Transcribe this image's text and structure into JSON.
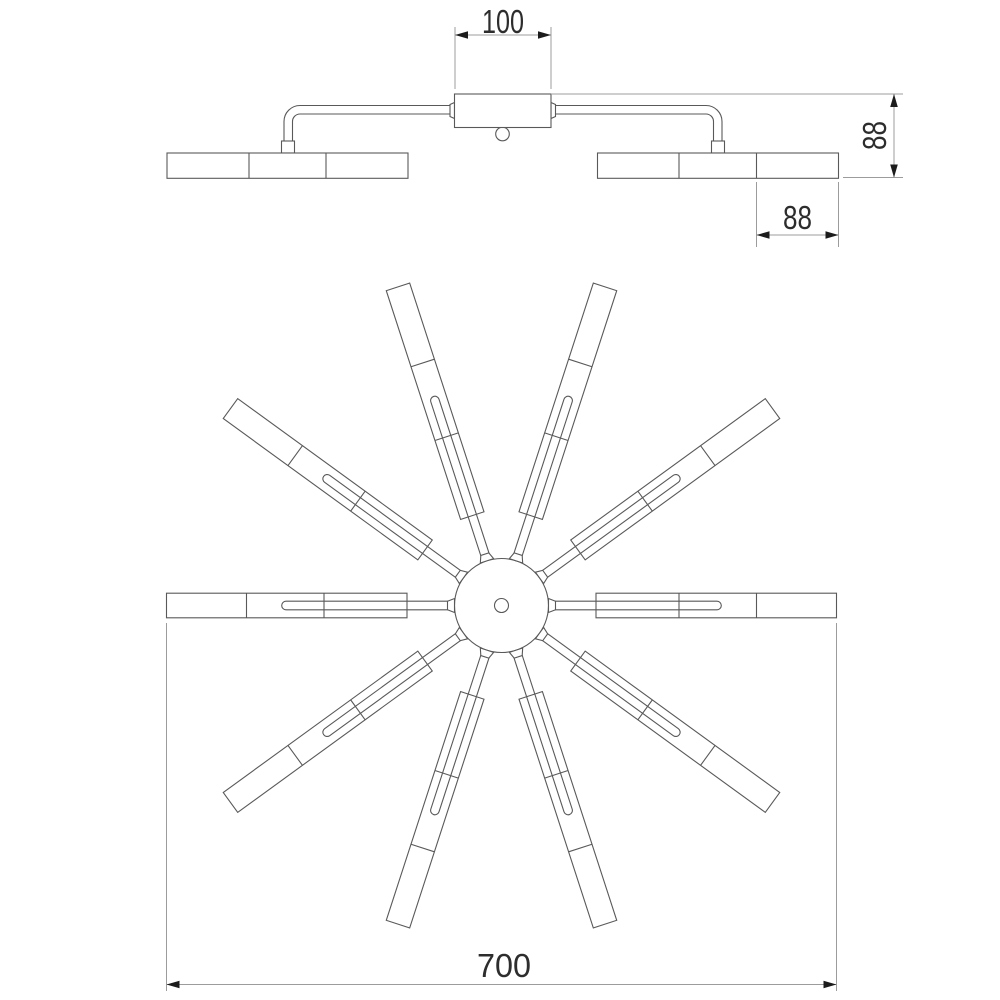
{
  "drawing": {
    "description": "Technical dimension drawing of a multi-arm LED ceiling chandelier: side elevation view (top) and plan view (bottom)",
    "background": "#ffffff",
    "outline_color": "#595959",
    "dim_line_color": "#9c9c9c",
    "arrow_color": "#1c1c1c",
    "text_color": "#2d2d2d",
    "views": {
      "elevation": {
        "name": "side elevation",
        "bar_segments": 3,
        "arms_visible": 2
      },
      "plan": {
        "name": "top plan",
        "arm_count": 10,
        "arm_angle_step_deg": 36
      }
    },
    "dims": {
      "canopy_width": "100",
      "fixture_height": "88",
      "bar_segment_width": "88",
      "overall_diameter": "700"
    }
  }
}
